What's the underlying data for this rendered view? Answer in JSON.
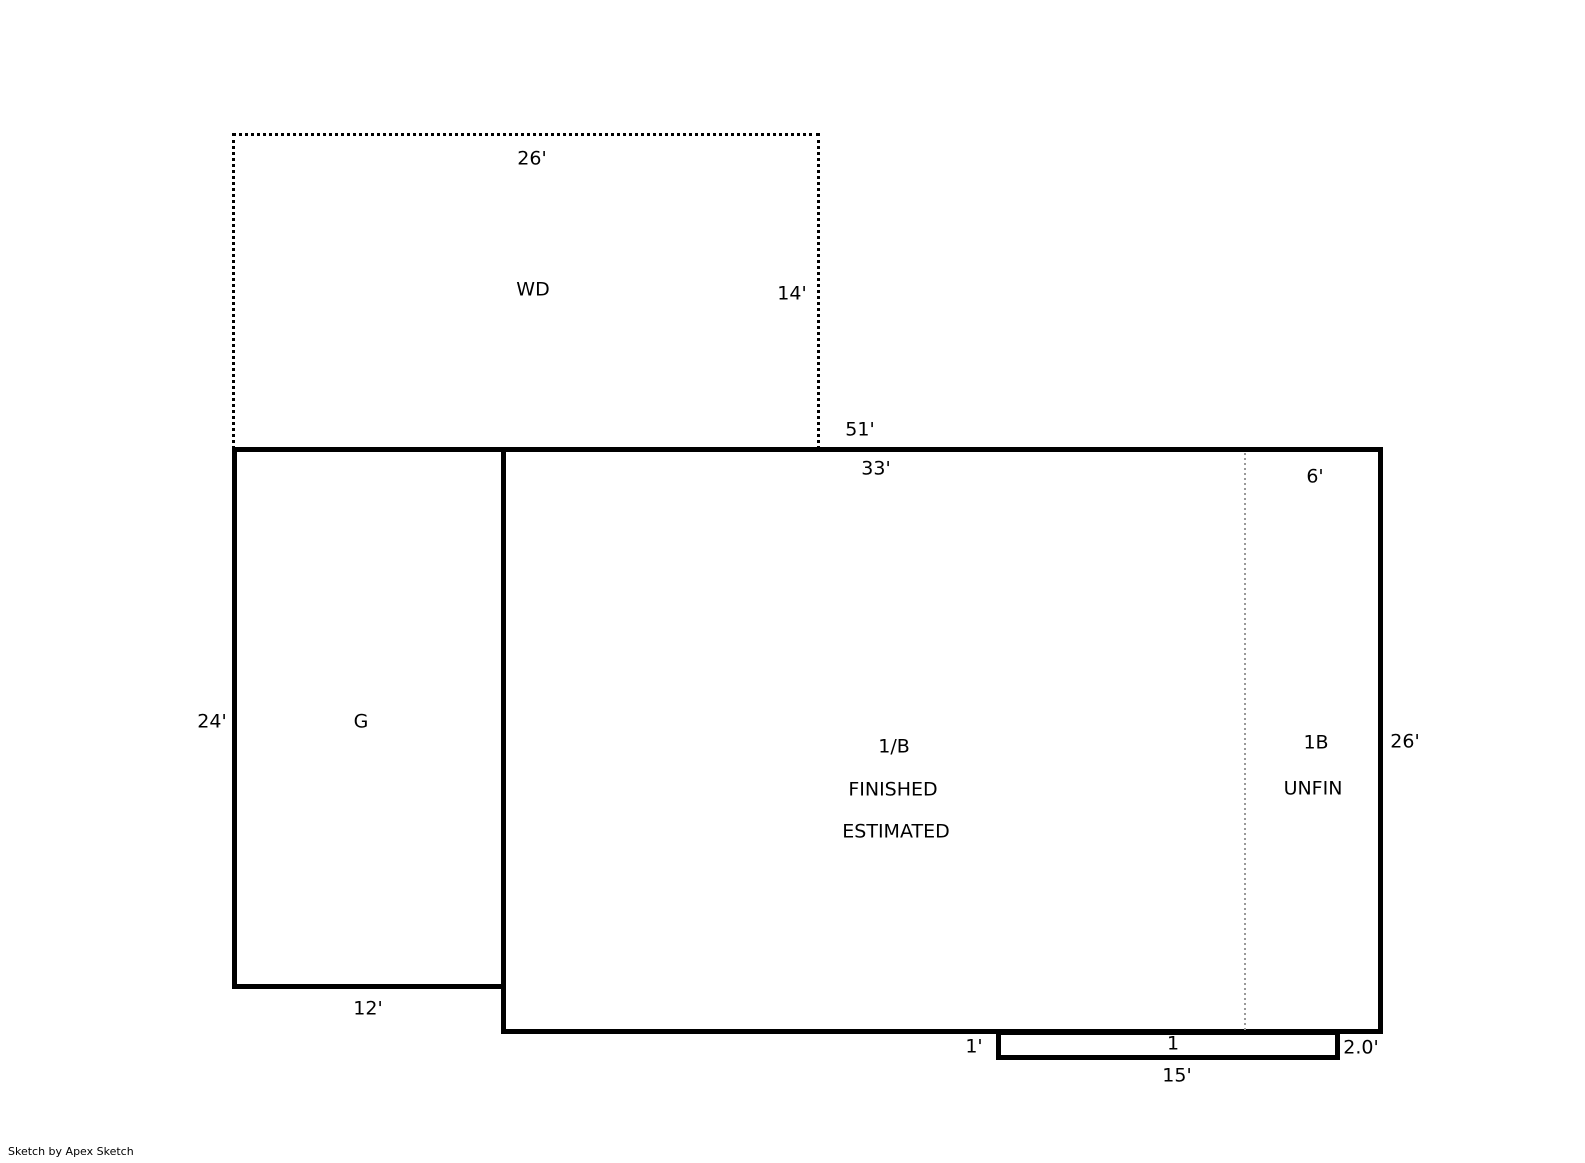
{
  "watermark": "Sketch by Apex Sketch",
  "areas": {
    "wd": {
      "label": "WD",
      "top_dim": "26'",
      "right_dim": "14'"
    },
    "garage": {
      "label": "G",
      "left_dim": "24'",
      "bottom_dim": "12'"
    },
    "main": {
      "overall_top_dim": "51'",
      "finished_top_dim": "33'",
      "unfin_top_dim": "6'",
      "right_dim": "26'",
      "finished_label_line1": "1/B",
      "finished_label_line2": "FINISHED",
      "finished_label_line3": "ESTIMATED",
      "unfin_label_line1": "1B",
      "unfin_label_line2": "UNFIN"
    },
    "bump": {
      "left_dim": "1'",
      "top_dim": "1",
      "right_dim": "2.0'",
      "bottom_dim": "15'"
    }
  },
  "colors": {
    "line": "#000000",
    "partition_line": "#999999",
    "background": "#ffffff"
  }
}
